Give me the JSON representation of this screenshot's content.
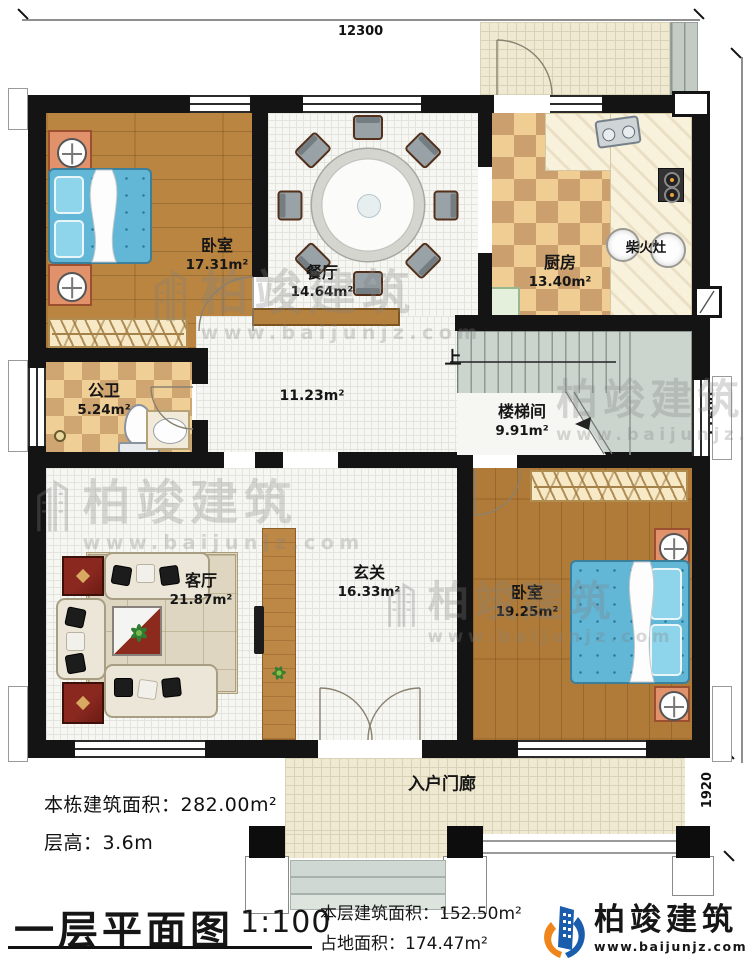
{
  "dimensions": {
    "top": "12300",
    "right": "11600",
    "right_lower": "1920"
  },
  "rooms": {
    "bedroom_top_left": {
      "name": "卧室",
      "area": "17.31m²"
    },
    "dining": {
      "name": "餐厅",
      "area": "14.64m²"
    },
    "kitchen": {
      "name": "厨房",
      "area": "13.40m²"
    },
    "wood_stove": {
      "name": "柴火灶"
    },
    "bathroom": {
      "name": "公卫",
      "area": "5.24m²"
    },
    "hallway": {
      "area": "11.23m²"
    },
    "stairwell": {
      "name": "楼梯间",
      "area": "9.91m²",
      "up": "上"
    },
    "living": {
      "name": "客厅",
      "area": "21.87m²"
    },
    "foyer": {
      "name": "玄关",
      "area": "16.33m²"
    },
    "bedroom_right": {
      "name": "卧室",
      "area": "19.25m²"
    },
    "porch": {
      "name": "入户门廊"
    }
  },
  "notes": {
    "building_total": "本栋建筑面积：282.00m²",
    "floor_height": "层高：3.6m"
  },
  "title_block": {
    "title": "一层平面图",
    "scale": "1:100",
    "floor_area": "本层建筑面积：152.50m²",
    "land_area": "占地面积：174.47m²"
  },
  "brand": {
    "name": "柏竣建筑",
    "url": "www.baijunjz.com"
  },
  "watermark": {
    "name": "柏竣建筑",
    "url": "www.baijunjz.com"
  },
  "colors": {
    "wall": "#141414",
    "wood_floor": "#b98540",
    "bed_blue": "#62b6d6",
    "checker_light": "#efcd93",
    "checker_dark": "#cb9f6e",
    "brand_blue": "#1a5dad",
    "brand_orange": "#f08519"
  }
}
